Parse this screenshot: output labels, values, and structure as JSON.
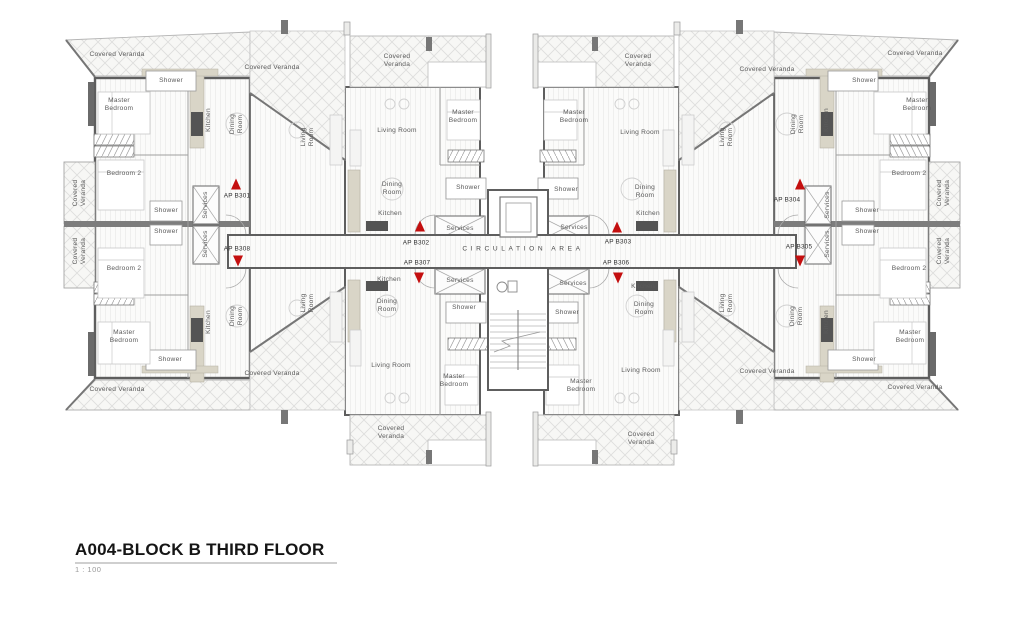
{
  "title": {
    "name": "A004-BLOCK B THIRD FLOOR",
    "scale": "1 : 100"
  },
  "corridor": {
    "label": "CIRCULATION AREA"
  },
  "colors": {
    "accent_red": "#c40f0f",
    "wall_gray": "#5e5e5e",
    "counter_beige": "#d9d5c7",
    "veranda_hatch": "#dddddc"
  },
  "apartments": [
    {
      "label": "AP B301",
      "x": 237,
      "y": 196,
      "tri": "up",
      "tx": 236,
      "ty": 184
    },
    {
      "label": "AP B302",
      "x": 416,
      "y": 243,
      "tri": "up",
      "tx": 420,
      "ty": 226
    },
    {
      "label": "AP B303",
      "x": 618,
      "y": 242,
      "tri": "up",
      "tx": 617,
      "ty": 227
    },
    {
      "label": "AP B304",
      "x": 787,
      "y": 200,
      "tri": "up",
      "tx": 800,
      "ty": 184
    },
    {
      "label": "AP B305",
      "x": 799,
      "y": 247,
      "tri": "down",
      "tx": 800,
      "ty": 261
    },
    {
      "label": "AP B306",
      "x": 616,
      "y": 263,
      "tri": "down",
      "tx": 618,
      "ty": 278
    },
    {
      "label": "AP B307",
      "x": 417,
      "y": 263,
      "tri": "down",
      "tx": 419,
      "ty": 278
    },
    {
      "label": "AP B308",
      "x": 237,
      "y": 249,
      "tri": "down",
      "tx": 238,
      "ty": 261
    }
  ],
  "rooms": [
    {
      "t": "Covered Veranda",
      "x": 117,
      "y": 55
    },
    {
      "t": "Covered Veranda",
      "x": 272,
      "y": 68
    },
    {
      "t": "Shower",
      "x": 171,
      "y": 81
    },
    {
      "t": "Master\nBedroom",
      "x": 119,
      "y": 105
    },
    {
      "t": "Kitchen",
      "x": 209,
      "y": 120,
      "r": 1
    },
    {
      "t": "Dining\nRoom",
      "x": 237,
      "y": 124,
      "r": 1
    },
    {
      "t": "Living\nRoom",
      "x": 308,
      "y": 137,
      "r": 1
    },
    {
      "t": "Bedroom 2",
      "x": 124,
      "y": 174
    },
    {
      "t": "Covered\nVeranda",
      "x": 80,
      "y": 193,
      "r": 1
    },
    {
      "t": "Shower",
      "x": 166,
      "y": 211
    },
    {
      "t": "Services",
      "x": 206,
      "y": 205,
      "r": 1
    },
    {
      "t": "Covered\nVeranda",
      "x": 80,
      "y": 251,
      "r": 1
    },
    {
      "t": "Shower",
      "x": 166,
      "y": 232
    },
    {
      "t": "Services",
      "x": 206,
      "y": 244,
      "r": 1
    },
    {
      "t": "Bedroom 2",
      "x": 124,
      "y": 269
    },
    {
      "t": "Master\nBedroom",
      "x": 124,
      "y": 337
    },
    {
      "t": "Shower",
      "x": 170,
      "y": 360
    },
    {
      "t": "Kitchen",
      "x": 209,
      "y": 322,
      "r": 1
    },
    {
      "t": "Dining\nRoom",
      "x": 237,
      "y": 316,
      "r": 1
    },
    {
      "t": "Living\nRoom",
      "x": 308,
      "y": 303,
      "r": 1
    },
    {
      "t": "Covered Veranda",
      "x": 117,
      "y": 390
    },
    {
      "t": "Covered Veranda",
      "x": 272,
      "y": 374
    },
    {
      "t": "Covered\nVeranda",
      "x": 397,
      "y": 61
    },
    {
      "t": "Living Room",
      "x": 397,
      "y": 131
    },
    {
      "t": "Master\nBedroom",
      "x": 463,
      "y": 117
    },
    {
      "t": "Dining\nRoom",
      "x": 392,
      "y": 189
    },
    {
      "t": "Kitchen",
      "x": 390,
      "y": 214
    },
    {
      "t": "Shower",
      "x": 468,
      "y": 188
    },
    {
      "t": "Services",
      "x": 460,
      "y": 229
    },
    {
      "t": "Services",
      "x": 460,
      "y": 281
    },
    {
      "t": "Shower",
      "x": 464,
      "y": 308
    },
    {
      "t": "Kitchen",
      "x": 389,
      "y": 280
    },
    {
      "t": "Dining\nRoom",
      "x": 387,
      "y": 306
    },
    {
      "t": "Living Room",
      "x": 391,
      "y": 366
    },
    {
      "t": "Master\nBedroom",
      "x": 454,
      "y": 381
    },
    {
      "t": "Covered\nVeranda",
      "x": 391,
      "y": 433
    },
    {
      "t": "Covered\nVeranda",
      "x": 638,
      "y": 61
    },
    {
      "t": "Master\nBedroom",
      "x": 574,
      "y": 117
    },
    {
      "t": "Living Room",
      "x": 640,
      "y": 133
    },
    {
      "t": "Shower",
      "x": 566,
      "y": 190
    },
    {
      "t": "Dining\nRoom",
      "x": 645,
      "y": 192
    },
    {
      "t": "Kitchen",
      "x": 648,
      "y": 214
    },
    {
      "t": "Services",
      "x": 574,
      "y": 228
    },
    {
      "t": "Services",
      "x": 573,
      "y": 284
    },
    {
      "t": "Shower",
      "x": 567,
      "y": 313
    },
    {
      "t": "Kitchen",
      "x": 643,
      "y": 287
    },
    {
      "t": "Dining\nRoom",
      "x": 644,
      "y": 309
    },
    {
      "t": "Living Room",
      "x": 641,
      "y": 371
    },
    {
      "t": "Master\nBedroom",
      "x": 581,
      "y": 386
    },
    {
      "t": "Covered\nVeranda",
      "x": 641,
      "y": 439
    },
    {
      "t": "Covered Veranda",
      "x": 767,
      "y": 70
    },
    {
      "t": "Covered Veranda",
      "x": 915,
      "y": 54
    },
    {
      "t": "Shower",
      "x": 864,
      "y": 81
    },
    {
      "t": "Master\nBedroom",
      "x": 917,
      "y": 105
    },
    {
      "t": "Kitchen",
      "x": 827,
      "y": 120,
      "r": 1
    },
    {
      "t": "Dining\nRoom",
      "x": 798,
      "y": 124,
      "r": 1
    },
    {
      "t": "Living\nRoom",
      "x": 727,
      "y": 137,
      "r": 1
    },
    {
      "t": "Bedroom 2",
      "x": 909,
      "y": 174
    },
    {
      "t": "Services",
      "x": 828,
      "y": 205,
      "r": 1
    },
    {
      "t": "Shower",
      "x": 867,
      "y": 211
    },
    {
      "t": "Covered\nVeranda",
      "x": 944,
      "y": 193,
      "r": 1
    },
    {
      "t": "Services",
      "x": 828,
      "y": 244,
      "r": 1
    },
    {
      "t": "Shower",
      "x": 867,
      "y": 232
    },
    {
      "t": "Covered\nVeranda",
      "x": 944,
      "y": 251,
      "r": 1
    },
    {
      "t": "Bedroom 2",
      "x": 909,
      "y": 269
    },
    {
      "t": "Dining\nRoom",
      "x": 797,
      "y": 316,
      "r": 1
    },
    {
      "t": "Kitchen",
      "x": 827,
      "y": 322,
      "r": 1
    },
    {
      "t": "Living\nRoom",
      "x": 727,
      "y": 303,
      "r": 1
    },
    {
      "t": "Master\nBedroom",
      "x": 910,
      "y": 337
    },
    {
      "t": "Shower",
      "x": 864,
      "y": 360
    },
    {
      "t": "Covered Veranda",
      "x": 767,
      "y": 372
    },
    {
      "t": "Covered Veranda",
      "x": 915,
      "y": 388
    }
  ]
}
